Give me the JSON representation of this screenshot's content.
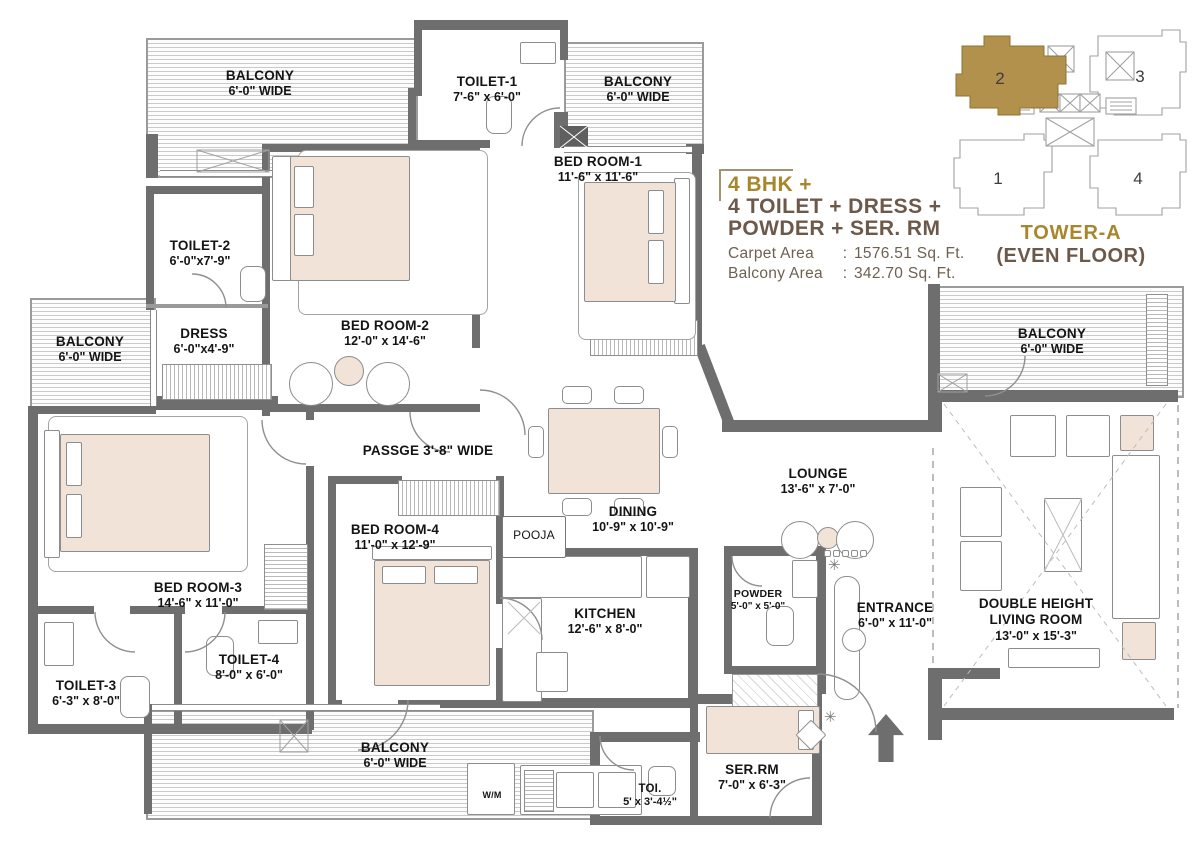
{
  "title_block": {
    "line1": "4 BHK +",
    "line2": "4 TOILET + DRESS +",
    "line3": "POWDER + SER. RM",
    "carpet": {
      "label": "Carpet Area",
      "separator": ":",
      "value": "1576.51 Sq. Ft."
    },
    "balcony": {
      "label": "Balcony Area",
      "separator": ":",
      "value": "342.70 Sq. Ft."
    },
    "accent_gold": "#a8862c",
    "accent_brown": "#6d594a"
  },
  "key_plan": {
    "title": "TOWER-A",
    "subtitle": "(EVEN FLOOR)",
    "units": [
      "1",
      "2",
      "3",
      "4"
    ],
    "highlighted_unit": "2",
    "highlight_color": "#b2914d"
  },
  "icons": {
    "plant_glyph": "✳"
  },
  "rooms": {
    "balcony_tl": {
      "name": "BALCONY",
      "dims": "6'-0\" WIDE"
    },
    "toilet1": {
      "name": "TOILET-1",
      "dims": "7'-6\" x 6'-0\""
    },
    "balcony_tr": {
      "name": "BALCONY",
      "dims": "6'-0\" WIDE"
    },
    "bedroom1": {
      "name": "BED ROOM-1",
      "dims": "11'-6\" x 11'-6\""
    },
    "toilet2": {
      "name": "TOILET-2",
      "dims": "6'-0\"x7'-9\""
    },
    "dress": {
      "name": "DRESS",
      "dims": "6'-0\"x4'-9\""
    },
    "bedroom2": {
      "name": "BED ROOM-2",
      "dims": "12'-0\" x 14'-6\""
    },
    "balcony_left": {
      "name": "BALCONY",
      "dims": "6'-0\" WIDE"
    },
    "passage": {
      "name": "PASSGE 3'-8\" WIDE"
    },
    "bedroom3": {
      "name": "BED ROOM-3",
      "dims": "14'-6\" x 11'-0\""
    },
    "toilet3": {
      "name": "TOILET-3",
      "dims": "6'-3\" x 8'-0\""
    },
    "toilet4": {
      "name": "TOILET-4",
      "dims": "8'-0\" x 6'-0\""
    },
    "bedroom4": {
      "name": "BED ROOM-4",
      "dims": "11'-0\" x 12'-9\""
    },
    "pooja": {
      "name": "POOJA"
    },
    "dining": {
      "name": "DINING",
      "dims": "10'-9\" x 10'-9\""
    },
    "kitchen": {
      "name": "KITCHEN",
      "dims": "12'-6\" x 8'-0\""
    },
    "lounge": {
      "name": "LOUNGE",
      "dims": "13'-6\" x 7'-0\""
    },
    "powder": {
      "name": "POWDER",
      "dims": "5'-0\" x 5'-0\""
    },
    "entrance": {
      "name": "ENTRANCE",
      "dims": "6'-0\" x 11'-0\""
    },
    "living": {
      "name": "DOUBLE HEIGHT",
      "name2": "LIVING ROOM",
      "dims": "13'-0\" x 15'-3\""
    },
    "balcony_right": {
      "name": "BALCONY",
      "dims": "6'-0\" WIDE"
    },
    "balcony_bottom": {
      "name": "BALCONY",
      "dims": "6'-0\" WIDE"
    },
    "serrm": {
      "name": "SER.RM",
      "dims": "7'-0\" x 6'-3\""
    },
    "toi": {
      "name": "TOI.",
      "dims": "5' x 3'-4½\""
    },
    "wm": {
      "name": "W/M"
    }
  }
}
